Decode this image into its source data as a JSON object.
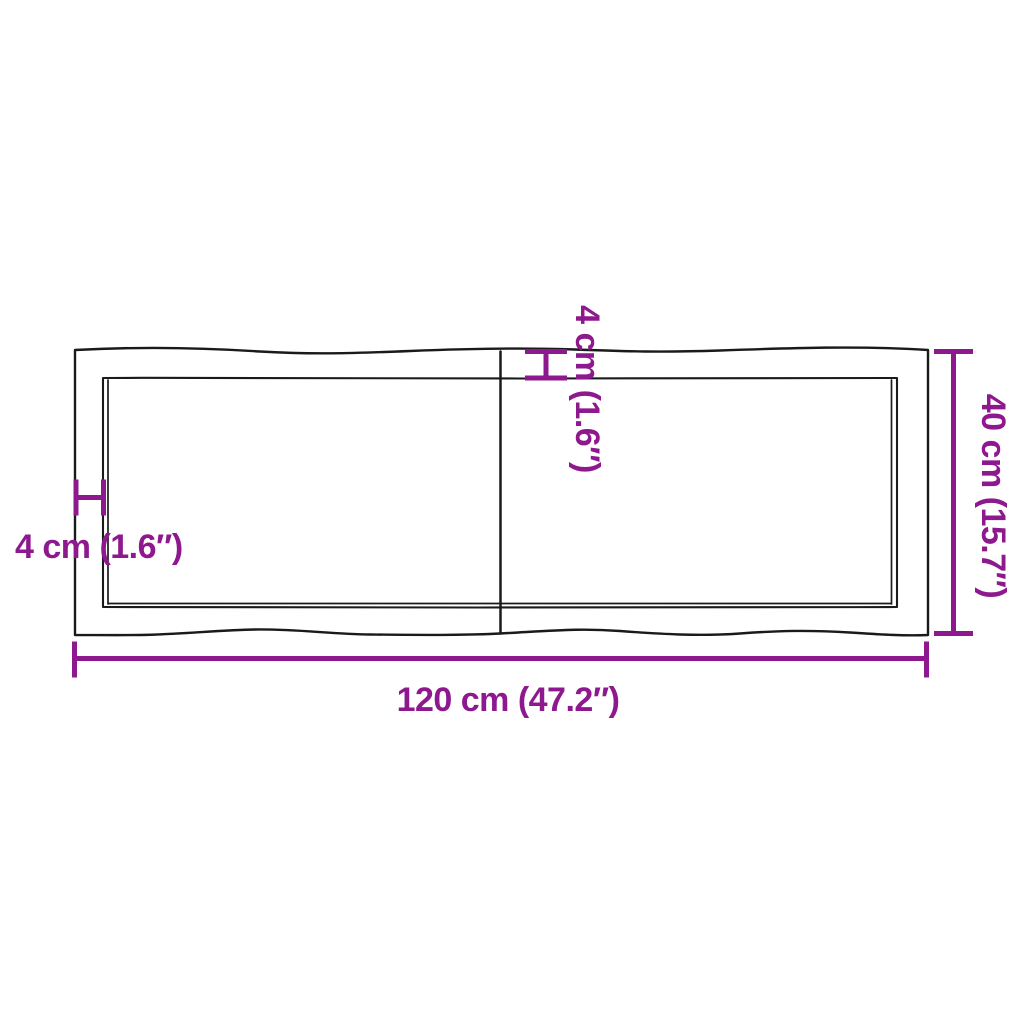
{
  "diagram": {
    "type": "product-dimension-drawing",
    "subject": "table-top-with-live-edges-two-boards",
    "colors": {
      "dimension": "#8E188E",
      "outline": "#1A1A1A",
      "background": "#FFFFFF"
    },
    "dimensions": {
      "length": {
        "label": "120 cm (47.2″)",
        "cm": 120,
        "inches": 47.2
      },
      "width": {
        "label": "40 cm (15.7″)",
        "cm": 40,
        "inches": 15.7
      },
      "edge_left": {
        "label": "4 cm (1.6″)",
        "cm": 4,
        "inches": 1.6
      },
      "edge_top": {
        "label": "4 cm (1.6″)",
        "cm": 4,
        "inches": 1.6
      }
    }
  }
}
